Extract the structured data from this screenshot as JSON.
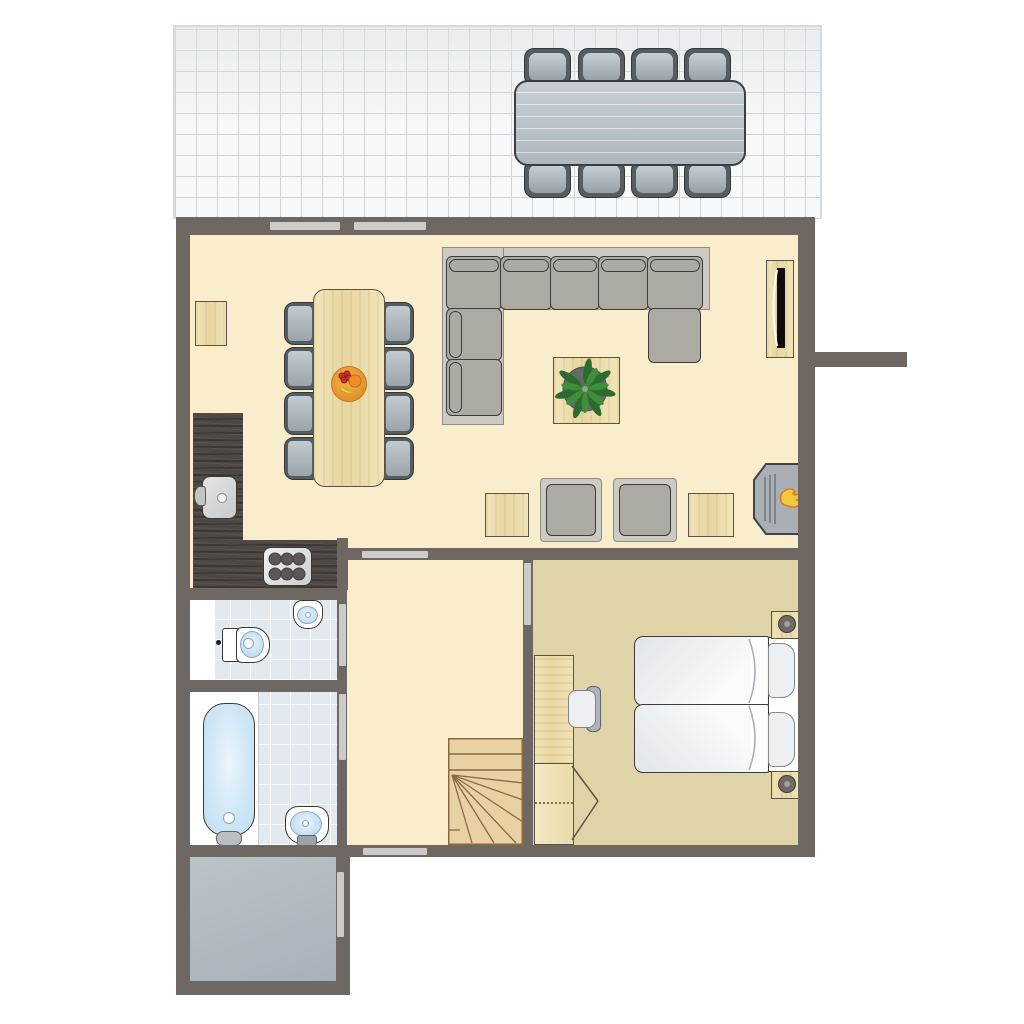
{
  "title": "Holiday home ground floor plan",
  "colors": {
    "wall": "#6F6761",
    "opening": "#CCCBC9",
    "floor_cream": "#F9EDCB",
    "floor_khaki": "#DFD3A8",
    "tile_terrace": "#F6F8F9",
    "tile_line": "#CED3D6",
    "tile_bath": "#E2EAEF",
    "porch": "#B1BCC2",
    "counter": "#4E4845",
    "sofa_base": "#CBCAC3",
    "cushion": "#ADA9A3",
    "cushion_border": "#3E3B37",
    "chair_dark": "#565C60",
    "wood_light": "#EFE2B4",
    "stairs_wood": "#E8D1A3",
    "stairs_line": "#8A6A45",
    "flame_yellow": "#F6C83D",
    "flame_orange": "#E0791F",
    "plant_green": "#3E8E3A",
    "water_blue": "#BFDDF1",
    "mattress": "#F3F6F8",
    "tv_black": "#0E0D0C"
  },
  "rooms": [
    {
      "id": "terrace",
      "label": "terrace",
      "furniture": [
        "outdoor dining table",
        "8 outdoor chairs"
      ]
    },
    {
      "id": "living-room",
      "label": "living room",
      "furniture": [
        "dining table",
        "8 dining chairs",
        "fruit bowl",
        "wall side table",
        "corner sofa with chaise",
        "coffee table",
        "potted plant",
        "wall-mounted tv",
        "2 armchairs",
        "2 side tables",
        "wood stove fireplace"
      ]
    },
    {
      "id": "kitchen",
      "label": "open kitchen",
      "furniture": [
        "l-shaped counter",
        "sink",
        "6-burner stove"
      ]
    },
    {
      "id": "toilet-room",
      "label": "toilet room",
      "furniture": [
        "toilet",
        "washbasin"
      ]
    },
    {
      "id": "bathroom",
      "label": "bathroom",
      "furniture": [
        "bathtub",
        "washbasin"
      ]
    },
    {
      "id": "hallway",
      "label": "hallway",
      "furniture": [
        "winder staircase"
      ]
    },
    {
      "id": "bedroom",
      "label": "bedroom",
      "furniture": [
        "double bed",
        "2 pillows",
        "2 nightstands with lamps",
        "desk",
        "desk chair",
        "wardrobe"
      ]
    },
    {
      "id": "porch",
      "label": "entrance porch",
      "furniture": []
    }
  ],
  "counts": {
    "terrace_chairs": 8,
    "dining_chairs": 8,
    "stove_burners": 6,
    "mattresses": 2,
    "pillows": 2,
    "nightstands": 2,
    "armchairs": 2
  }
}
